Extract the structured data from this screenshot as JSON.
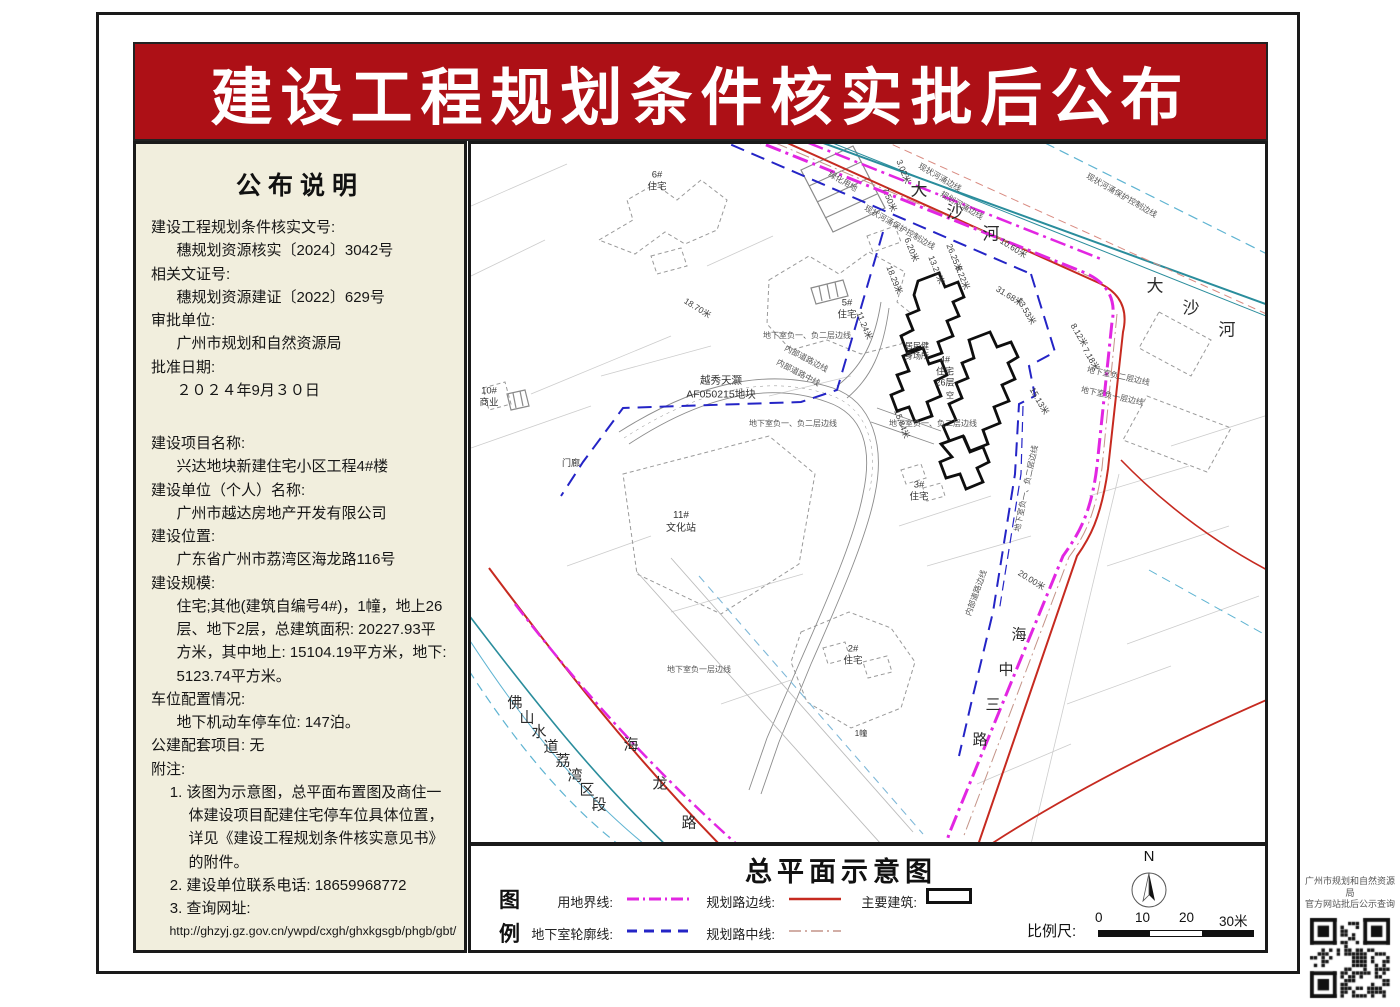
{
  "page": {
    "title": "建设工程规划条件核实批后公布"
  },
  "colors": {
    "banner": "#ad1016",
    "panel_bg": "#f1eedd",
    "parcel_line": "#e226e2",
    "basement_line": "#2424c6",
    "road_edge": "#c62a20",
    "road_center": "#c49488",
    "river_edge": "#2a8d9c",
    "river_control": "#5fb4d2"
  },
  "announcement": {
    "heading": "公布说明",
    "lines_top": [
      {
        "t": "建设工程规划条件核实文号:",
        "ind": 0
      },
      {
        "t": "穗规划资源核实〔2024〕3042号",
        "ind": 1
      },
      {
        "t": "相关文证号:",
        "ind": 0
      },
      {
        "t": "穗规划资源建证〔2022〕629号",
        "ind": 1
      },
      {
        "t": "审批单位:",
        "ind": 0
      },
      {
        "t": "广州市规划和自然资源局",
        "ind": 1
      },
      {
        "t": "批准日期:",
        "ind": 0
      },
      {
        "t": "２０２４年9月３０日",
        "ind": 1
      }
    ],
    "lines_main": [
      {
        "t": "建设项目名称:",
        "ind": 0
      },
      {
        "t": "兴达地块新建住宅小区工程4#楼",
        "ind": 1
      },
      {
        "t": "建设单位（个人）名称:",
        "ind": 0
      },
      {
        "t": "广州市越达房地产开发有限公司",
        "ind": 1
      },
      {
        "t": "建设位置:",
        "ind": 0
      },
      {
        "t": "广东省广州市荔湾区海龙路116号",
        "ind": 1
      },
      {
        "t": "建设规模:",
        "ind": 0
      },
      {
        "t": "住宅;其他(建筑自编号4#)，1幢，地上26层、地下2层，总建筑面积: 20227.93平方米，其中地上: 15104.19平方米，地下: 5123.74平方米。",
        "ind": 1
      },
      {
        "t": "车位配置情况:",
        "ind": 0
      },
      {
        "t": "地下机动车停车位: 147泊。",
        "ind": 1
      },
      {
        "t": "公建配套项目: 无",
        "ind": 0
      },
      {
        "t": "附注:",
        "ind": 0
      },
      {
        "t": "1. 该图为示意图，总平面布置图及商住一体建设项目配建住宅停车位具体位置，详见《建设工程规划条件核实意见书》的附件。",
        "ind": 2
      },
      {
        "t": "2. 建设单位联系电话: 18659968772",
        "ind": 2
      },
      {
        "t": "3. 查询网址:",
        "ind": 2
      },
      {
        "t": "http://ghzyj.gz.gov.cn/ywpd/cxgh/ghxkgsgb/phgb/gbt/",
        "ind": 3
      }
    ]
  },
  "map": {
    "char_labels": [
      {
        "text": "大沙河",
        "x": 448,
        "y": 44,
        "dx": 36,
        "dy": 22,
        "size": 17
      },
      {
        "text": "大沙河",
        "x": 684,
        "y": 140,
        "dx": 36,
        "dy": 22,
        "size": 17
      },
      {
        "text": "佛山水道荔湾区段",
        "x": 44,
        "y": 558,
        "dx": 12,
        "dy": 14.5,
        "size": 15
      },
      {
        "text": "海龙路",
        "x": 160,
        "y": 600,
        "dx": 29,
        "dy": 39,
        "size": 15
      },
      {
        "text": "海中三路",
        "x": 548,
        "y": 490,
        "dx": -13,
        "dy": 35,
        "size": 15
      }
    ],
    "dim_labels": [
      {
        "t": "18.70米",
        "x": 214,
        "y": 150,
        "r": 32
      },
      {
        "t": "18.29米",
        "x": 418,
        "y": 116,
        "r": 68
      },
      {
        "t": "11.24米",
        "x": 388,
        "y": 162,
        "r": 68
      },
      {
        "t": "3.02米",
        "x": 428,
        "y": 10,
        "r": 68
      },
      {
        "t": "7.50米",
        "x": 414,
        "y": 38,
        "r": 68
      },
      {
        "t": "6.20米",
        "x": 436,
        "y": 88,
        "r": 68
      },
      {
        "t": "13.27米",
        "x": 460,
        "y": 106,
        "r": 68
      },
      {
        "t": "26.25米",
        "x": 478,
        "y": 94,
        "r": 68
      },
      {
        "t": "8.22米",
        "x": 487,
        "y": 116,
        "r": 68
      },
      {
        "t": "10.60米",
        "x": 530,
        "y": 90,
        "r": 32
      },
      {
        "t": "31.68米",
        "x": 526,
        "y": 138,
        "r": 32
      },
      {
        "t": "13.53米",
        "x": 548,
        "y": 148,
        "r": 60
      },
      {
        "t": "8.12米",
        "x": 602,
        "y": 174,
        "r": 60
      },
      {
        "t": "7.18米",
        "x": 614,
        "y": 198,
        "r": 60
      },
      {
        "t": "15.13米",
        "x": 561,
        "y": 238,
        "r": 60
      },
      {
        "t": "15.84米",
        "x": 426,
        "y": 260,
        "r": 70
      },
      {
        "t": "20.00米",
        "x": 548,
        "y": 422,
        "r": 32
      }
    ],
    "line_labels": [
      {
        "t": "现状河涌保护控制边线",
        "x": 616,
        "y": 26,
        "r": 30
      },
      {
        "t": "现状河涌保护控制边线",
        "x": 394,
        "y": 58,
        "r": 30
      },
      {
        "t": "现状河涌边线",
        "x": 448,
        "y": 16,
        "r": 30
      },
      {
        "t": "规划河涌边线",
        "x": 470,
        "y": 44,
        "r": 30
      },
      {
        "t": "绿化用地",
        "x": 358,
        "y": 24,
        "r": 30
      },
      {
        "t": "地下室负一、负二层边线",
        "x": 292,
        "y": 186,
        "r": 0
      },
      {
        "t": "地下室负一、负二层边线",
        "x": 278,
        "y": 274,
        "r": 0
      },
      {
        "t": "地下室负一、负二层边线",
        "x": 418,
        "y": 274,
        "r": 0
      },
      {
        "t": "地下室负一、负二层边线",
        "x": 546,
        "y": 382,
        "r": -78
      },
      {
        "t": "地下室负二层边线",
        "x": 616,
        "y": 220,
        "r": 12
      },
      {
        "t": "地下室负一层边线",
        "x": 610,
        "y": 240,
        "r": 12
      },
      {
        "t": "地下室负一层边线",
        "x": 196,
        "y": 520,
        "r": 0
      },
      {
        "t": "内部道路边线",
        "x": 314,
        "y": 198,
        "r": 28
      },
      {
        "t": "内部道路中线",
        "x": 306,
        "y": 212,
        "r": 28
      },
      {
        "t": "内部道路边线",
        "x": 497,
        "y": 466,
        "r": -70
      }
    ],
    "building_labels": [
      {
        "lines": [
          "6#",
          "住宅"
        ],
        "x": 186,
        "y": 38,
        "size": 9.5
      },
      {
        "lines": [
          "5#",
          "住宅"
        ],
        "x": 376,
        "y": 166,
        "size": 9.5
      },
      {
        "lines": [
          "10#",
          "商业"
        ],
        "x": 18,
        "y": 254,
        "size": 9.5
      },
      {
        "lines": [
          "门廊"
        ],
        "x": 100,
        "y": 320,
        "size": 9
      },
      {
        "lines": [
          "11#",
          "文化站"
        ],
        "x": 210,
        "y": 378,
        "size": 10
      },
      {
        "lines": [
          "越秀天灏",
          "AF050215地块"
        ],
        "x": 250,
        "y": 244,
        "size": 10.5
      },
      {
        "lines": [
          "4#",
          "住宅",
          "26层"
        ],
        "x": 474,
        "y": 228,
        "size": 9
      },
      {
        "lines": [
          "居民健",
          "身场所"
        ],
        "x": 446,
        "y": 208,
        "size": 8
      },
      {
        "lines": [
          "空"
        ],
        "x": 479,
        "y": 252,
        "size": 8
      },
      {
        "lines": [
          "3#",
          "住宅"
        ],
        "x": 448,
        "y": 348,
        "size": 9.5
      },
      {
        "lines": [
          "2#",
          "住宅"
        ],
        "x": 382,
        "y": 512,
        "size": 9.5
      },
      {
        "lines": [
          "1幢"
        ],
        "x": 390,
        "y": 590,
        "size": 8
      }
    ]
  },
  "legend": {
    "title": "总平面示意图",
    "key_char_1": "图",
    "key_char_2": "例",
    "items": {
      "parcel": "用地界线:",
      "basement": "地下室轮廓线:",
      "road_edge": "规划路边线:",
      "road_center": "规划路中线:",
      "building": "主要建筑:"
    },
    "north_label": "N",
    "scale_label": "比例尺:",
    "scale_ticks": [
      "0",
      "10",
      "20",
      "30米"
    ]
  },
  "qr": {
    "caption_line1": "广州市规划和自然资源局",
    "caption_line2": "官方网站批后公示查询"
  }
}
